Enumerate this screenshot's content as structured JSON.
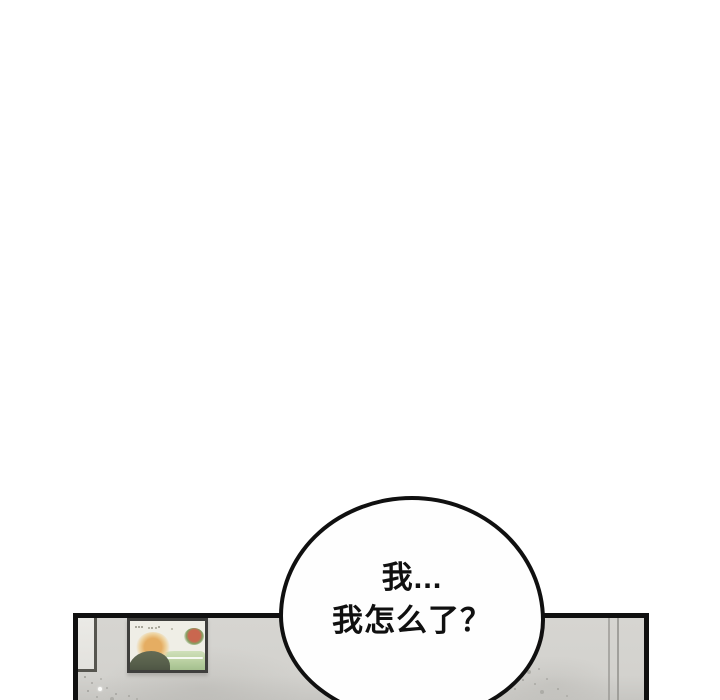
{
  "speech_bubble": {
    "lines": [
      "我...",
      "我怎么了？"
    ]
  },
  "colors": {
    "page-bg": "#ffffff",
    "ink": "#101010",
    "wall": "#d6d5d1",
    "wall-shade": "#c7c6c2",
    "wall-line": "#9b9a96",
    "frame-border": "#3f3f3d",
    "art-paper": "#efeee6",
    "art-sun": "#e5ad62",
    "art-sun-halo": "#eed29e",
    "art-hill": "#575f4b",
    "art-field": "#bdd3a5",
    "art-field-deep": "#a4bf8e",
    "art-bush-red": "#c9674f",
    "art-bush-green": "#84a062",
    "whiteboard": "#ebeae6",
    "bubble-fill": "#fefefe"
  }
}
